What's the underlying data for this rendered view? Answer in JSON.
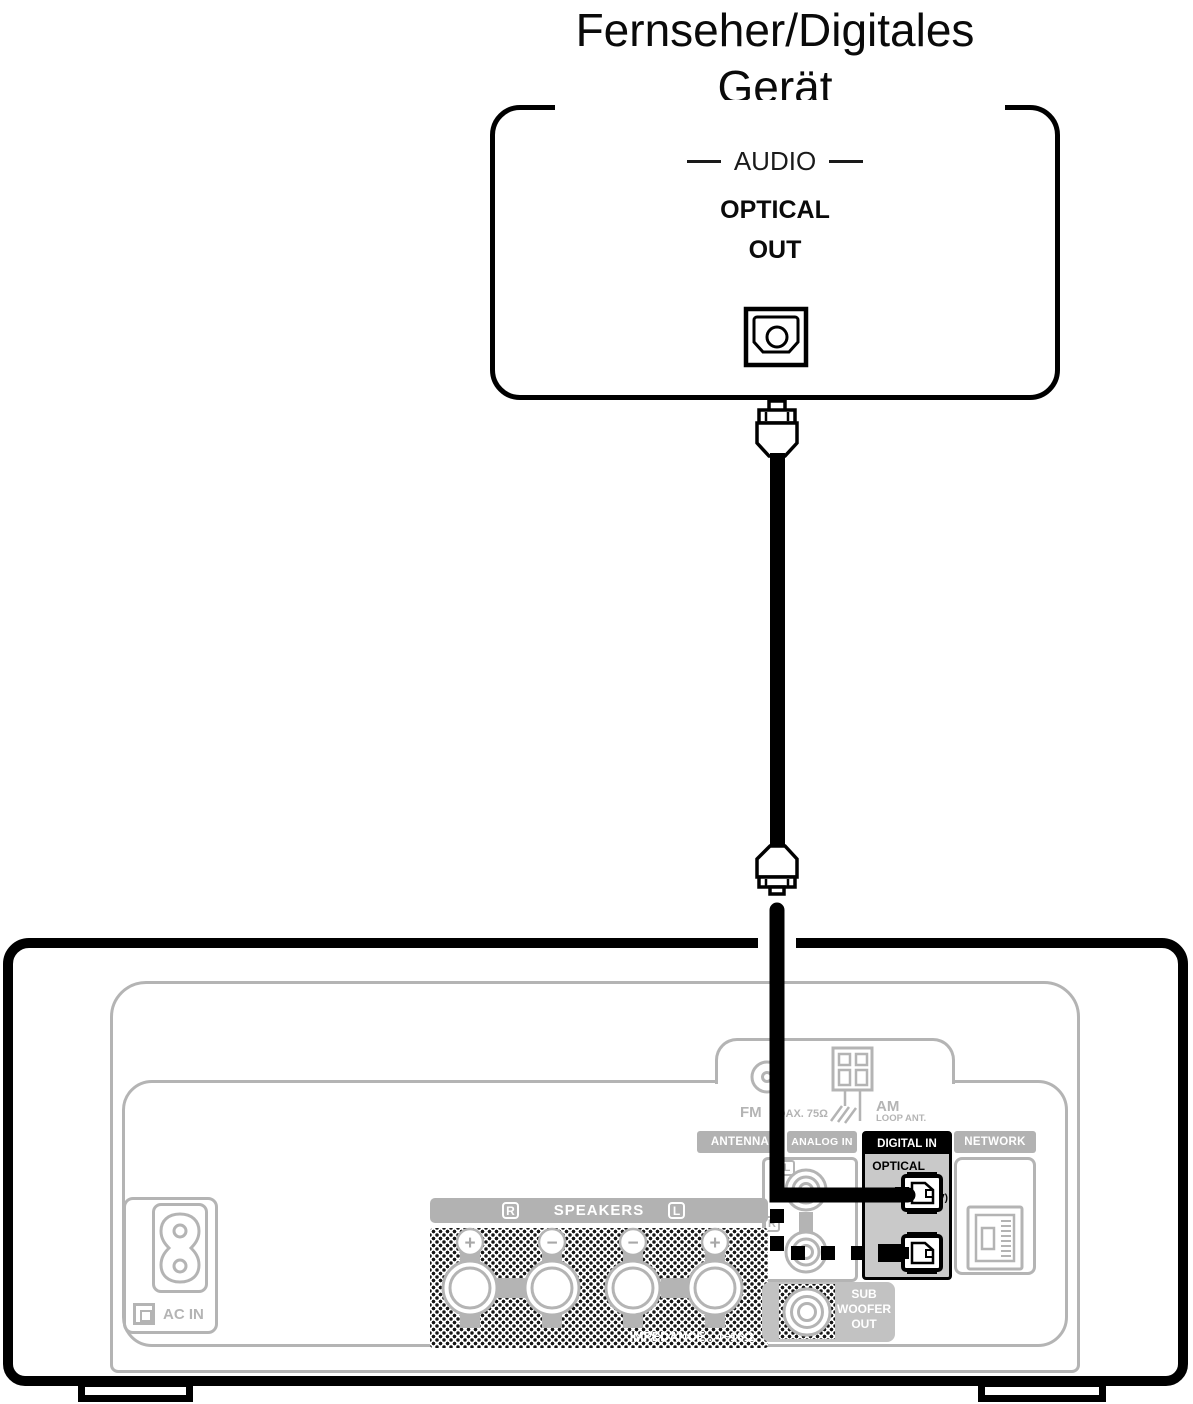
{
  "device": {
    "title_line1": "Fernseher/Digitales",
    "title_line2": "Gerät",
    "audio_label": "AUDIO",
    "optical_label": "OPTICAL",
    "out_label": "OUT"
  },
  "receiver": {
    "section_bars": {
      "antenna": "ANTENNA",
      "analog_in": "ANALOG IN",
      "digital_in": "DIGITAL IN",
      "network": "NETWORK"
    },
    "antenna": {
      "fm_label": "FM",
      "fm_spec": "COAX. 75Ω",
      "am_label": "AM",
      "am_sub": "LOOP ANT."
    },
    "digital": {
      "optical_label": "OPTICAL",
      "port1_number": "1",
      "port1_tag": "(TV)",
      "port2_number": "2"
    },
    "analog": {
      "left_label": "L",
      "right_label": "R"
    },
    "speakers": {
      "title": "SPEAKERS",
      "right_label": "R",
      "left_label": "L",
      "terminal_signs": [
        "+",
        "−",
        "−",
        "+"
      ],
      "impedance": "IMPEDANCE : 4~16Ω"
    },
    "subwoofer": {
      "line1": "SUB",
      "line2": "WOOFER",
      "line3": "OUT"
    },
    "power": {
      "ac_in_label": "AC IN"
    }
  },
  "colors": {
    "line_gray": "#b4b4b4",
    "panel_gray": "#c9c9c9",
    "black": "#000000"
  }
}
